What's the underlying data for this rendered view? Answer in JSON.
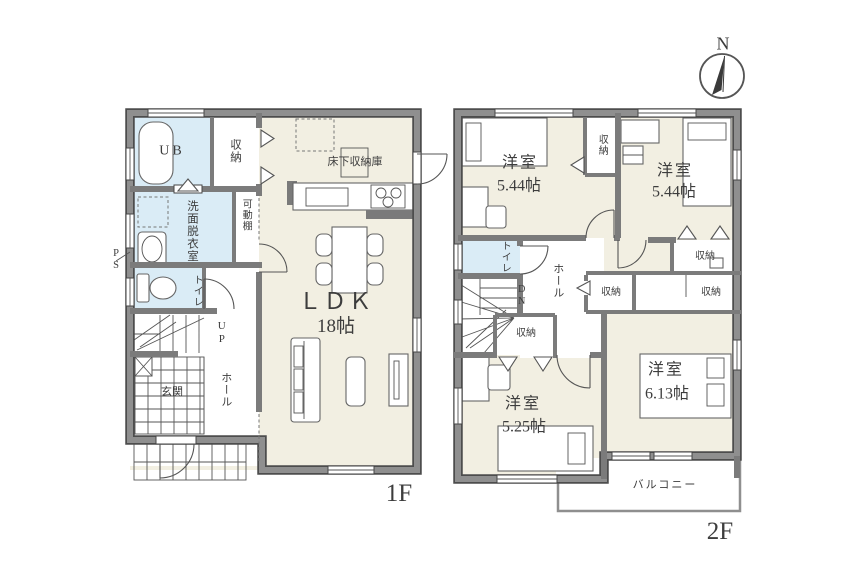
{
  "colors": {
    "wall": "#8f8f8f",
    "wall_edge": "#4d4d4d",
    "floor": "#f2efe2",
    "wet_room": "#daecf6",
    "line": "#555555"
  },
  "compass": {
    "north_label": "N"
  },
  "floor1": {
    "floor_label": "1F",
    "ldk": {
      "name": "ＬＤＫ",
      "size": "18帖"
    },
    "unit_bath": "UB",
    "storage": "収納",
    "underfloor_storage": "床下収納庫",
    "washroom": "洗面脱衣室",
    "movable_shelf": "可動棚",
    "pipe_space": "PS",
    "toilet": "トイレ",
    "stairs_up": "UP",
    "entrance": "玄関",
    "hall": "ホール"
  },
  "floor2": {
    "floor_label": "2F",
    "bedroom_nw": {
      "name": "洋室",
      "size": "5.44帖"
    },
    "bedroom_ne": {
      "name": "洋室",
      "size": "5.44帖"
    },
    "bedroom_sw": {
      "name": "洋室",
      "size": "5.25帖"
    },
    "bedroom_se": {
      "name": "洋室",
      "size": "6.13帖"
    },
    "toilet": "トイレ",
    "hall": "ホール",
    "stairs_down": "DN",
    "closet_between": "収納",
    "closet_stairs": "収納",
    "closet_center": "収納",
    "closet_se": "収納",
    "closet_ne": "収納",
    "balcony": "バルコニー"
  }
}
